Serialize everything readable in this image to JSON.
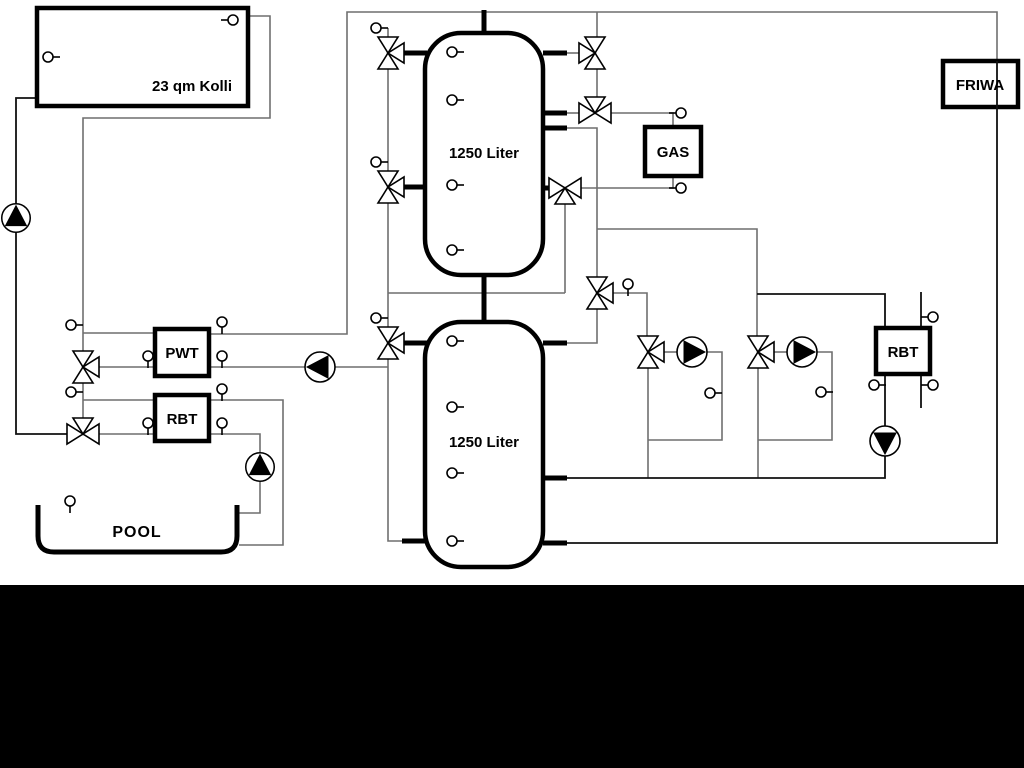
{
  "diagram": {
    "labels": {
      "collector": "23 qm Kolli",
      "tank1": "1250 Liter",
      "tank2": "1250 Liter",
      "pwt": "PWT",
      "rbt_left": "RBT",
      "rbt_right": "RBT",
      "gas": "GAS",
      "friwa": "FRIWA",
      "pool": "POOL"
    },
    "colors": {
      "pipe_gray": "#6f6f6f",
      "pipe_dark": "#111111",
      "symbol_black": "#000000",
      "background": "#ffffff",
      "bottom_bar": "#000000"
    }
  }
}
